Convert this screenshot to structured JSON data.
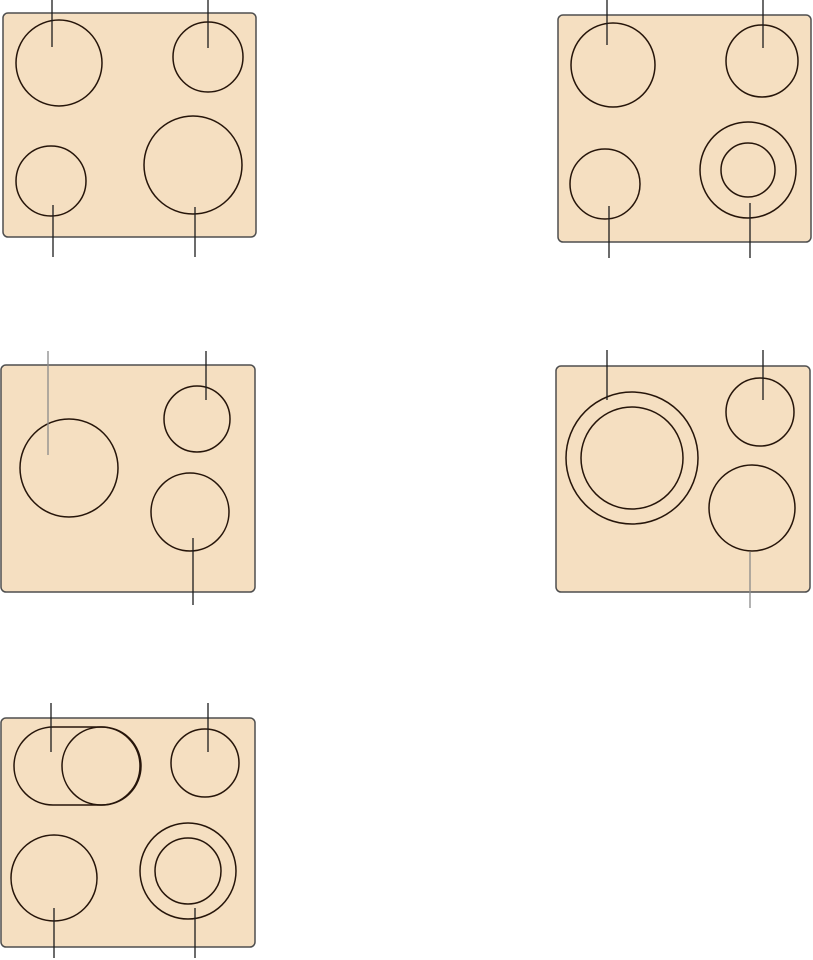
{
  "canvas": {
    "width": 813,
    "height": 960,
    "background": "#ffffff"
  },
  "style": {
    "panel_fill": "#f5dfc1",
    "panel_border": "#4f4f4f",
    "panel_corner_radius": 5,
    "panel_border_width": 1.5,
    "burner_stroke": "#26150a",
    "burner_stroke_width": 1.5,
    "leader_dark": "#1c1c1c",
    "leader_gray": "#8a8a8a",
    "leader_width": 1.3
  },
  "panels": [
    {
      "name": "cooktop-panel-1",
      "rect": {
        "x": 3,
        "y": 13,
        "w": 253,
        "h": 224
      },
      "burners": [
        {
          "cx": 59,
          "cy": 63,
          "rings": [
            43
          ]
        },
        {
          "cx": 208,
          "cy": 57,
          "rings": [
            35
          ]
        },
        {
          "cx": 51,
          "cy": 181,
          "rings": [
            35
          ]
        },
        {
          "cx": 193,
          "cy": 165,
          "rings": [
            49
          ]
        }
      ],
      "leaders": [
        {
          "x": 52,
          "y1": 0,
          "y2": 47,
          "tone": "dark"
        },
        {
          "x": 208,
          "y1": 0,
          "y2": 48,
          "tone": "dark"
        },
        {
          "x": 53,
          "y1": 205,
          "y2": 257,
          "tone": "dark"
        },
        {
          "x": 195,
          "y1": 207,
          "y2": 257,
          "tone": "dark"
        }
      ]
    },
    {
      "name": "cooktop-panel-2",
      "rect": {
        "x": 558,
        "y": 15,
        "w": 253,
        "h": 227
      },
      "burners": [
        {
          "cx": 613,
          "cy": 65,
          "rings": [
            42
          ]
        },
        {
          "cx": 762,
          "cy": 61,
          "rings": [
            36
          ]
        },
        {
          "cx": 605,
          "cy": 184,
          "rings": [
            35
          ]
        },
        {
          "cx": 748,
          "cy": 170,
          "rings": [
            48,
            27
          ]
        }
      ],
      "leaders": [
        {
          "x": 607,
          "y1": 0,
          "y2": 45,
          "tone": "dark"
        },
        {
          "x": 763,
          "y1": 0,
          "y2": 48,
          "tone": "dark"
        },
        {
          "x": 609,
          "y1": 206,
          "y2": 258,
          "tone": "dark"
        },
        {
          "x": 750,
          "y1": 203,
          "y2": 258,
          "tone": "dark"
        }
      ]
    },
    {
      "name": "cooktop-panel-3",
      "rect": {
        "x": 1,
        "y": 365,
        "w": 254,
        "h": 227
      },
      "burners": [
        {
          "cx": 69,
          "cy": 468,
          "rings": [
            49
          ]
        },
        {
          "cx": 197,
          "cy": 419,
          "rings": [
            33
          ]
        },
        {
          "cx": 190,
          "cy": 512,
          "rings": [
            39
          ]
        }
      ],
      "leaders": [
        {
          "x": 48,
          "y1": 351,
          "y2": 455,
          "tone": "gray"
        },
        {
          "x": 206,
          "y1": 351,
          "y2": 400,
          "tone": "dark"
        },
        {
          "x": 193,
          "y1": 538,
          "y2": 605,
          "tone": "dark"
        }
      ]
    },
    {
      "name": "cooktop-panel-4",
      "rect": {
        "x": 556,
        "y": 366,
        "w": 254,
        "h": 226
      },
      "burners": [
        {
          "cx": 632,
          "cy": 458,
          "rings": [
            66,
            51
          ]
        },
        {
          "cx": 760,
          "cy": 412,
          "rings": [
            34
          ]
        },
        {
          "cx": 752,
          "cy": 508,
          "rings": [
            43
          ]
        }
      ],
      "leaders": [
        {
          "x": 607,
          "y1": 350,
          "y2": 400,
          "tone": "dark"
        },
        {
          "x": 763,
          "y1": 350,
          "y2": 400,
          "tone": "dark"
        },
        {
          "x": 750,
          "y1": 552,
          "y2": 608,
          "tone": "gray"
        }
      ]
    },
    {
      "name": "cooktop-panel-5",
      "rect": {
        "x": 1,
        "y": 718,
        "w": 254,
        "h": 229
      },
      "burners": [
        {
          "cx": 101,
          "cy": 766,
          "rings": [
            39
          ],
          "stadium": {
            "x": 14,
            "y": 727,
            "w": 127,
            "h": 78
          }
        },
        {
          "cx": 205,
          "cy": 763,
          "rings": [
            34
          ]
        },
        {
          "cx": 54,
          "cy": 878,
          "rings": [
            43
          ]
        },
        {
          "cx": 188,
          "cy": 871,
          "rings": [
            48,
            33
          ]
        }
      ],
      "leaders": [
        {
          "x": 51,
          "y1": 703,
          "y2": 752,
          "tone": "dark"
        },
        {
          "x": 208,
          "y1": 703,
          "y2": 752,
          "tone": "dark"
        },
        {
          "x": 54,
          "y1": 908,
          "y2": 958,
          "tone": "dark"
        },
        {
          "x": 195,
          "y1": 908,
          "y2": 958,
          "tone": "dark"
        }
      ]
    }
  ]
}
